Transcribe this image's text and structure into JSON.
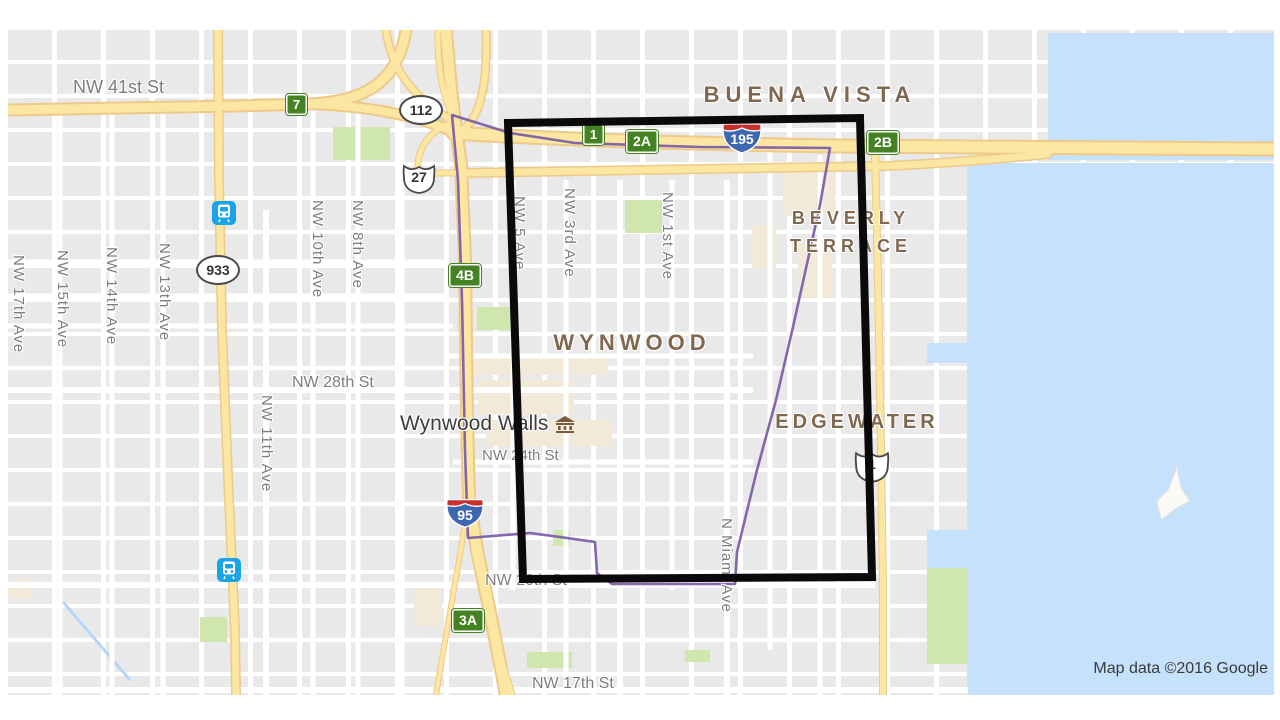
{
  "attribution": "Map data ©2016 Google",
  "neighborhoods": {
    "buena_vista": "BUENA VISTA",
    "beverly_terrace_line1": "BEVERLY",
    "beverly_terrace_line2": "TERRACE",
    "wynwood": "WYNWOOD",
    "edgewater": "EDGEWATER"
  },
  "streets": {
    "nw41": "NW 41st St",
    "nw28": "NW 28th St",
    "nw24": "NW 24th St",
    "nw20": "NW 20th St",
    "nw17": "NW 17th St"
  },
  "avenues": {
    "a17": "NW 17th Ave",
    "a15": "NW 15th Ave",
    "a14": "NW 14th Ave",
    "a13": "NW 13th Ave",
    "a11": "NW 11th Ave",
    "a10": "NW 10th Ave",
    "a8": "NW 8th Ave",
    "a5": "NW 5 Ave",
    "a3": "NW 3rd Ave",
    "a1": "NW 1st Ave",
    "miami": "N Miami Ave"
  },
  "shields": {
    "exit7": "7",
    "exit1": "1",
    "exit2a": "2A",
    "exit2b": "2B",
    "exit4b": "4B",
    "exit3a": "3A",
    "route112": "112",
    "route933": "933",
    "us27": "27",
    "us1": "1",
    "i195": "195",
    "i95": "95"
  },
  "poi": {
    "wynwood_walls": "Wynwood Walls"
  },
  "colors": {
    "water": "#c6e1fc",
    "park": "#cfe7ae",
    "highway_fill": "#fbe7a2",
    "highway_casing": "#eec98a",
    "boundary_purple": "#7d5fa8",
    "rectangle_black": "#0a0a0a",
    "neighborhood_text": "#80684e",
    "street_text": "#7d7d7d",
    "transit_blue": "#1aa3e8",
    "exit_green": "#458224",
    "interstate_blue": "#3e67b2",
    "interstate_red": "#c6312e"
  }
}
